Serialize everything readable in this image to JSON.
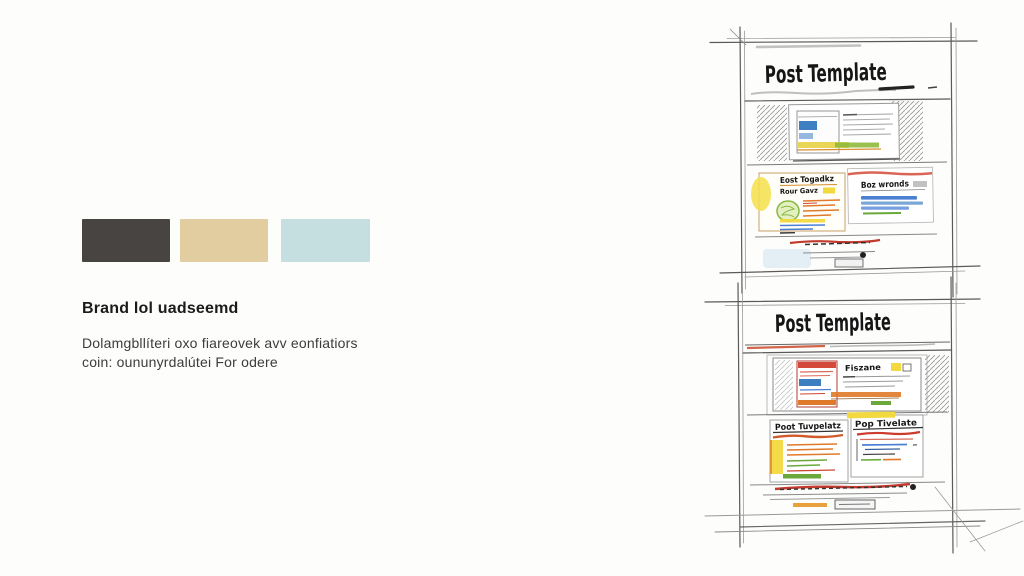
{
  "page": {
    "background": "#fdfdfc"
  },
  "palette": {
    "swatches": [
      {
        "name": "charcoal",
        "hex": "#474442"
      },
      {
        "name": "sand",
        "hex": "#e2cda1"
      },
      {
        "name": "pale-blue",
        "hex": "#c5dedf"
      }
    ]
  },
  "brand": {
    "heading": "Brand lol uadseemd",
    "body_lines": [
      "Dolamgbllíteri oxo fiareovek avv eonfiatiors",
      "coin: oununyrdalútei For odere"
    ]
  },
  "sketch": {
    "accent_colors": [
      "#f2d93f",
      "#e07a2a",
      "#d44a3a",
      "#6aa83c",
      "#4a7fd4"
    ],
    "panel1": {
      "title": "Post Template",
      "card_left": {
        "title": "Eost Togadkz",
        "subtitle": "Rour Gavz"
      },
      "card_right": {
        "title": "Boz wronds"
      }
    },
    "panel2": {
      "title": "Post Template",
      "window_label": "Fiszane",
      "card_left": {
        "title": "Poot Tuvpelatz"
      },
      "card_right": {
        "title": "Pop Tivelate"
      }
    }
  }
}
